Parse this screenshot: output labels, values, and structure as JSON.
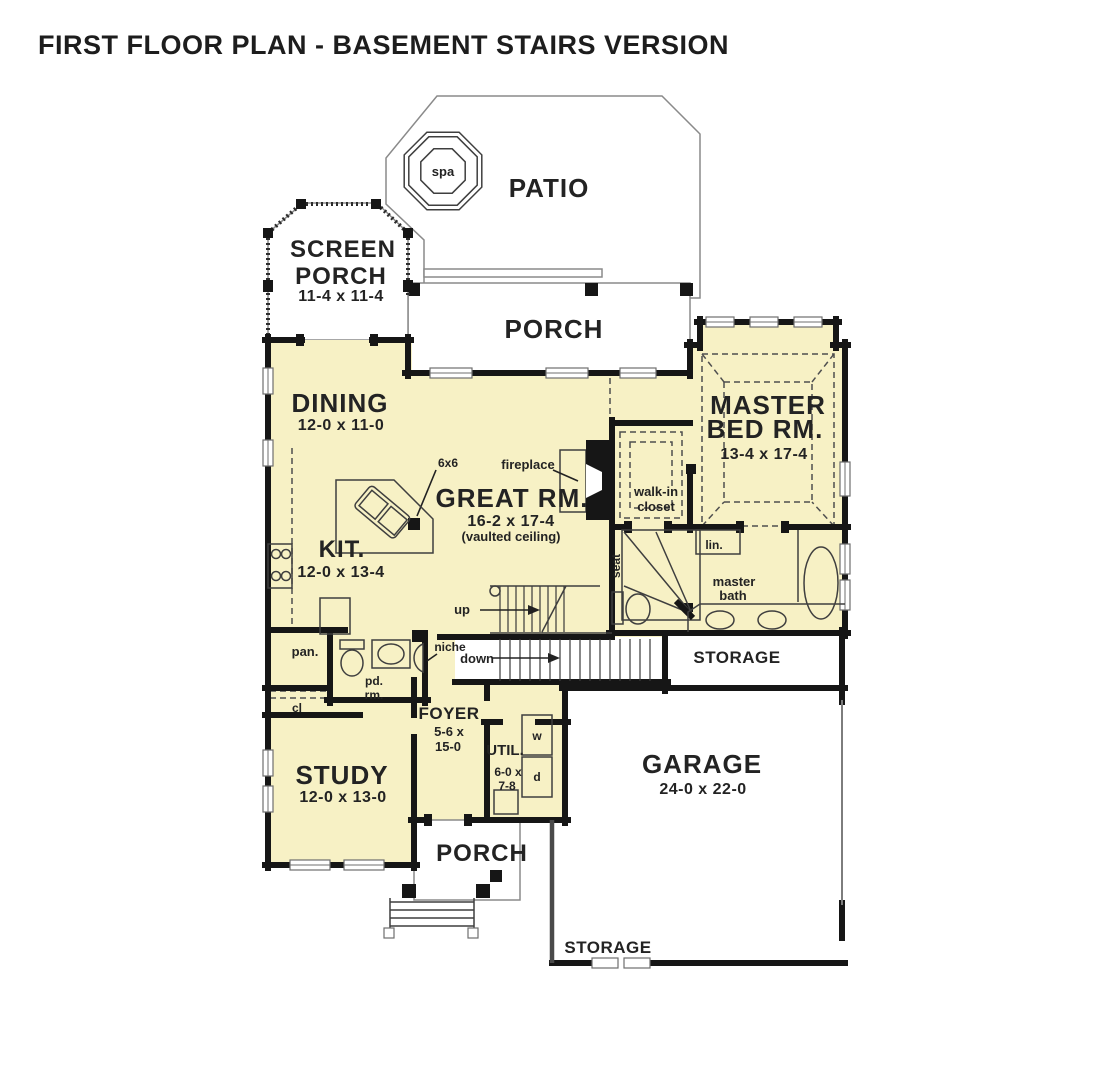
{
  "title": "FIRST FLOOR PLAN - BASEMENT STAIRS VERSION",
  "colors": {
    "room_fill": "#f7f1c5",
    "wall": "#161616",
    "text": "#232323"
  },
  "rooms": {
    "patio": {
      "label": "PATIO"
    },
    "spa": {
      "label": "spa"
    },
    "screen_porch": {
      "label1": "SCREEN",
      "label2": "PORCH",
      "dims": "11-4 x 11-4"
    },
    "rear_porch": {
      "label": "PORCH"
    },
    "dining": {
      "label": "DINING",
      "dims": "12-0 x 11-0"
    },
    "great_room": {
      "label": "GREAT RM.",
      "dims": "16-2 x 17-4",
      "note": "(vaulted ceiling)"
    },
    "master_bed": {
      "label1": "MASTER",
      "label2": "BED RM.",
      "dims": "13-4 x 17-4"
    },
    "walk_in_closet": {
      "label1": "walk-in",
      "label2": "closet"
    },
    "master_bath": {
      "label1": "master",
      "label2": "bath"
    },
    "kitchen": {
      "label": "KIT.",
      "dims": "12-0 x 13-4"
    },
    "pantry": {
      "label": "pan."
    },
    "powder_room": {
      "label1": "pd.",
      "label2": "rm."
    },
    "closet": {
      "label": "cl"
    },
    "foyer": {
      "label": "FOYER",
      "dims1": "5-6 x",
      "dims2": "15-0"
    },
    "utility": {
      "label": "UTIL.",
      "dims1": "6-0 x",
      "dims2": "7-8"
    },
    "study": {
      "label": "STUDY",
      "dims": "12-0 x 13-0"
    },
    "garage": {
      "label": "GARAGE",
      "dims": "24-0 x 22-0"
    },
    "front_porch": {
      "label": "PORCH"
    },
    "storage_mid": {
      "label": "STORAGE"
    },
    "storage_bottom": {
      "label": "STORAGE"
    }
  },
  "annotations": {
    "fireplace": "fireplace",
    "post": "6x6",
    "seat": "seat",
    "linen": "lin.",
    "stairs_up": "up",
    "stairs_down": "down",
    "niche": "niche",
    "washer": "w",
    "dryer": "d"
  }
}
